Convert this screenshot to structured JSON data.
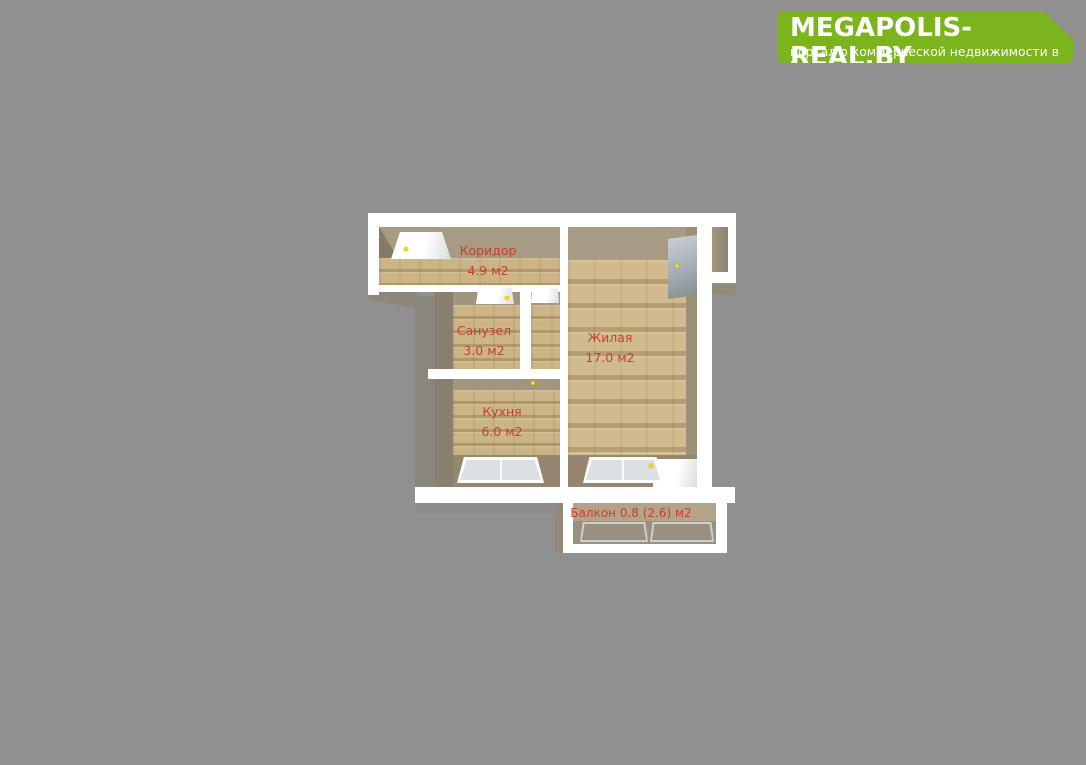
{
  "theme": {
    "background": "#909090",
    "wall_white": "#ffffff",
    "floor_beige": "#cbb486",
    "label_red": "#c7402e",
    "logo_green": "#7cb41d",
    "logo_orange": "#f08019"
  },
  "logo": {
    "title": "MEGAPOLIS-REAL.BY",
    "subtitle": "портал о коммерческой недвижимости в Беларуси"
  },
  "floorplan": {
    "rooms": [
      {
        "id": "corridor",
        "name": "Коридор",
        "area": "4.9 м2"
      },
      {
        "id": "bathroom",
        "name": "Санузел",
        "area": "3.0 м2"
      },
      {
        "id": "living",
        "name": "Жилая",
        "area": "17.0 м2"
      },
      {
        "id": "kitchen",
        "name": "Кухня",
        "area": "6.0 м2"
      },
      {
        "id": "balcony",
        "name": "Балкон",
        "area": "0.8 (2.6) м2",
        "label": "Балкон 0.8 (2.6) м2"
      }
    ]
  }
}
